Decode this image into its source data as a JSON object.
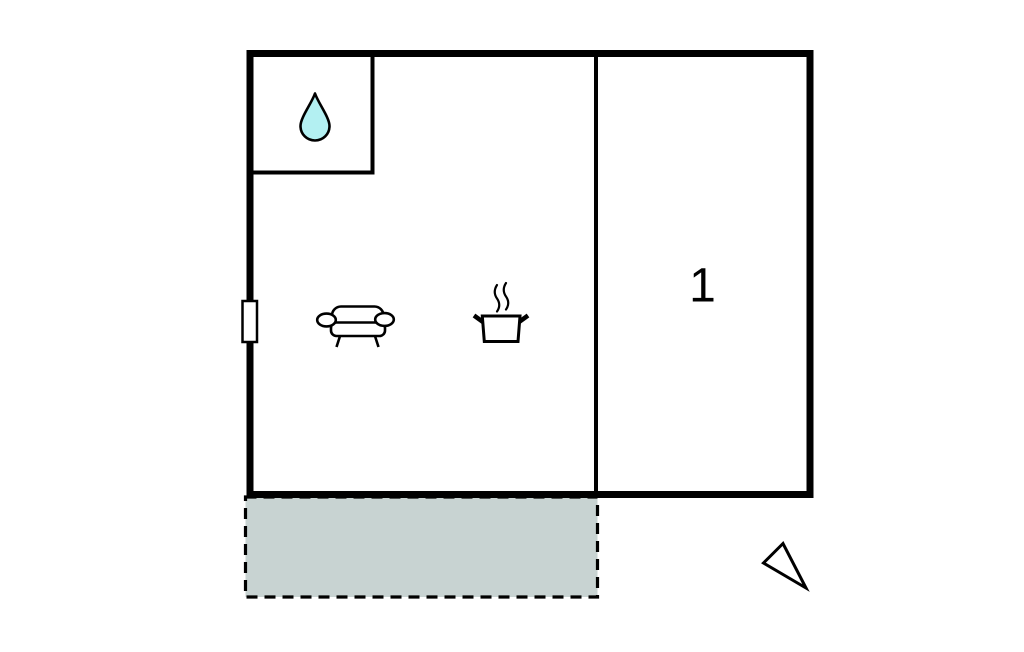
{
  "canvas": {
    "background": "#ffffff"
  },
  "floorplan": {
    "bedroom_label": "1",
    "colors": {
      "wall": "#000000",
      "terrace_fill": "#c8d3d2",
      "water_drop_fill": "#b3f0f2",
      "door_fill": "#ffffff",
      "line_art": "#000000"
    },
    "icons": {
      "bathroom": "water-drop-icon",
      "living_room": "sofa-icon",
      "kitchen": "cooking-pot-icon",
      "orientation_marker": "north-arrow-icon"
    }
  }
}
